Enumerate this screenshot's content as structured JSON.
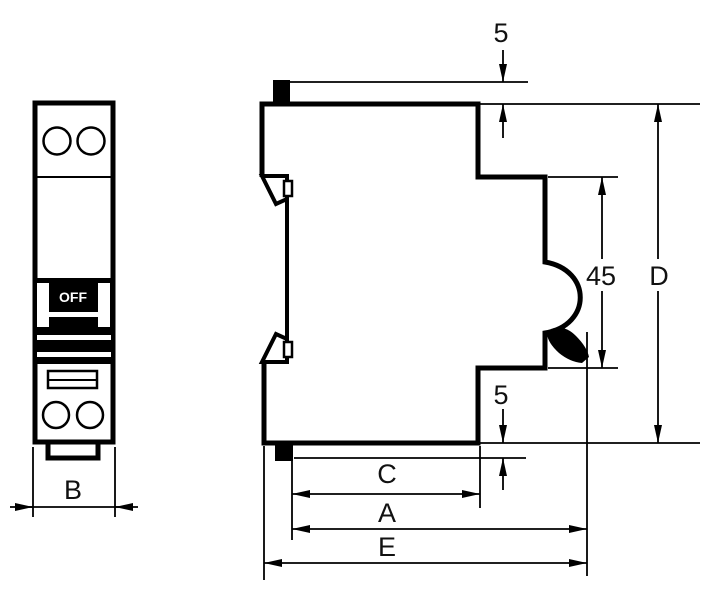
{
  "colors": {
    "background": "#ffffff",
    "line": "#000000",
    "label": "#111111",
    "switch_fill": "#000000",
    "switch_text": "#ffffff"
  },
  "front_view": {
    "switch_label": "OFF",
    "width_dim_label": "B"
  },
  "side_view": {
    "toggle_offset_label": "5",
    "base_offset_label": "5",
    "rail_height_label": "45",
    "overall_height_label": "D",
    "upper_depth_label": "C",
    "body_depth_label": "A",
    "overall_depth_label": "E"
  }
}
